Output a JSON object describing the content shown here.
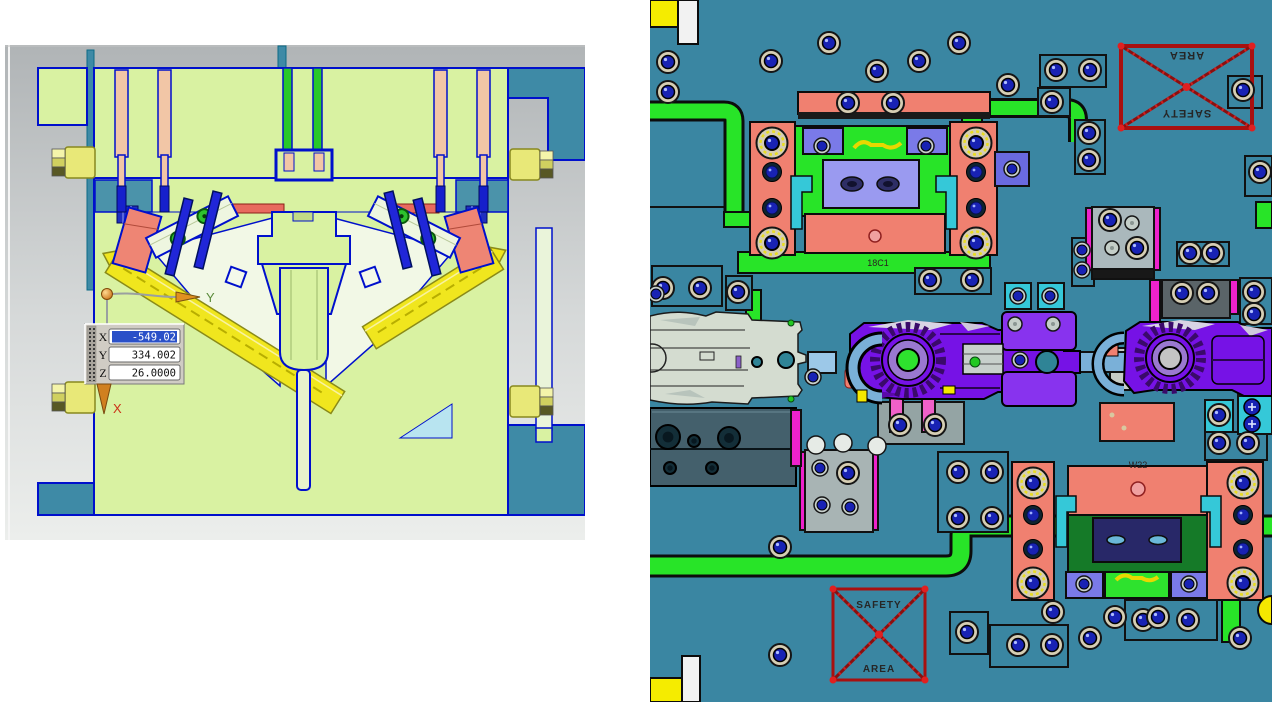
{
  "app": {
    "description": "CAD mold design dual viewport",
    "left_view_name": "mold cross-section view",
    "right_view_name": "mold plate top view"
  },
  "left_view": {
    "coordinate_readout": {
      "rows": [
        {
          "label": "X",
          "value": "-549.02",
          "selected": true
        },
        {
          "label": "Y",
          "value": "334.002",
          "selected": false
        },
        {
          "label": "Z",
          "value": "26.0000",
          "selected": false
        }
      ]
    },
    "axis_triad": {
      "y_label": "Y",
      "x_label": "X"
    }
  },
  "right_view": {
    "labels": {
      "top_block": "18C1",
      "bottom_block": "W22"
    },
    "safety_markers": [
      {
        "position": "top-right",
        "line1": "SAFETY",
        "line2": "AREA",
        "rotated": true
      },
      {
        "position": "bottom-left",
        "line1": "SAFETY",
        "line2": "AREA",
        "rotated": false
      }
    ]
  },
  "palette": {
    "left_bg_top": "#b0b4b6",
    "left_bg_bottom": "#eceeec",
    "mold_green": "#d9f2a2",
    "mold_teal": "#3e8aa6",
    "outline_blue": "#0010cc",
    "pin_pink": "#f2c6a6",
    "lifter_yellow": "#f0e61e",
    "right_bg_teal": "#3a86a2",
    "runner_green": "#28e428",
    "clamp_salmon": "#f08070",
    "latch_purple": "#7612e6",
    "magenta": "#ee22cc",
    "cyan_clip": "#35c8d8",
    "navy_screw": "#1822b4",
    "safety_red": "#a81010",
    "selection_blue": "#2a50c8"
  }
}
